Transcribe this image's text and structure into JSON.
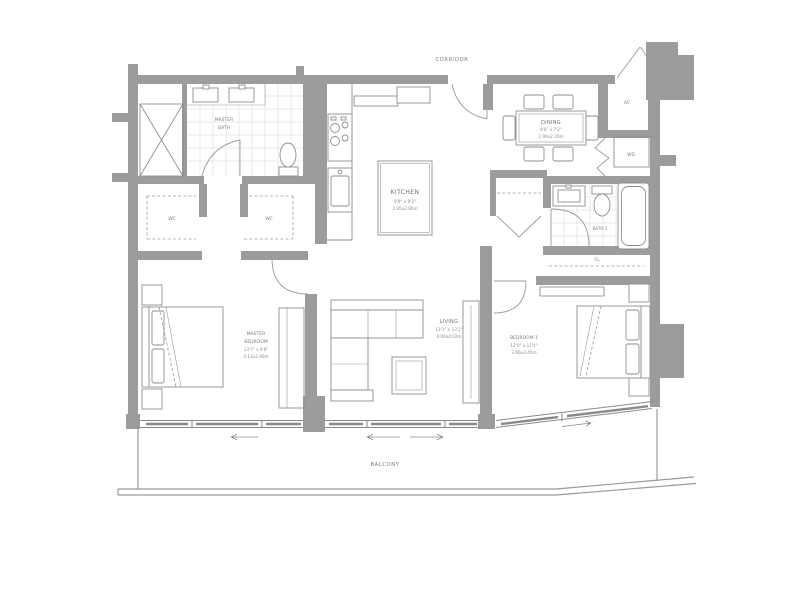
{
  "plan": {
    "corridor_label": "CORRIDOR",
    "balcony_label": "BALCONY",
    "rooms": {
      "master_bath": {
        "line1": "MASTER",
        "line2": "BATH"
      },
      "wc_left": "WC",
      "wc_right": "WC",
      "kitchen": {
        "name": "KITCHEN",
        "dim_ft": "9'8\" x 9'2\"",
        "dim_m": "2.95x2.80m"
      },
      "dining": {
        "name": "DINING",
        "dim_ft": "9'6\" x 7'2\"",
        "dim_m": "2.90x2.20m"
      },
      "ac": "AC",
      "wd": "WD",
      "bath1": "BATH 1",
      "cl": "CL",
      "master_bedroom": {
        "line1": "MASTER",
        "line2": "BEDROOM",
        "dim_ft": "13'7\" x 9'6\"",
        "dim_m": "4.13x2.90m"
      },
      "living": {
        "name": "LIVING",
        "dim_ft": "13'1\" x 13'2\"",
        "dim_m": "4.00x4.02m"
      },
      "bedroom1": {
        "name": "BEDROOM 1",
        "dim_ft": "12'0\" x 11'4\"",
        "dim_m": "3.66x3.45m"
      }
    },
    "colors": {
      "wall": "#9c9c9c",
      "furniture_line": "#8e8e8e",
      "tile_line": "#d4d4d4",
      "text": "#6f6f6f",
      "background": "#ffffff"
    }
  }
}
